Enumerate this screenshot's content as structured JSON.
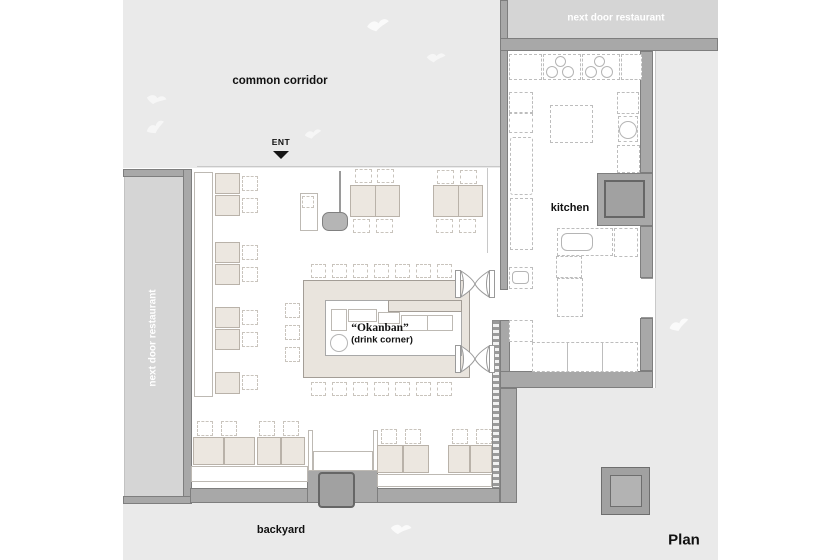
{
  "labels": {
    "common_corridor": "common corridor",
    "entrance": "ENT",
    "next_door_top": "next door restaurant",
    "next_door_left": "next door restaurant",
    "kitchen": "kitchen",
    "okanban": "“Okanban”",
    "okanban_sub": "(drink corner)",
    "backyard": "backyard",
    "plan": "Plan"
  },
  "colors": {
    "open_area_gray": "#eaeaea",
    "neighbor_block_gray": "#d5d5d5",
    "wall_gray": "#a8a8a8",
    "wall_edge": "#7e7e7e",
    "column_gray": "#a1a1a1",
    "table_beige": "#ece7e0",
    "counter_beige": "#e9e4dd",
    "label_text": "#111111",
    "neighbor_text": "#ffffff"
  },
  "icons": {
    "entrance_arrow_glyph": "▼",
    "door_swing": "double-swing-door",
    "bird": "bird-silhouette"
  }
}
